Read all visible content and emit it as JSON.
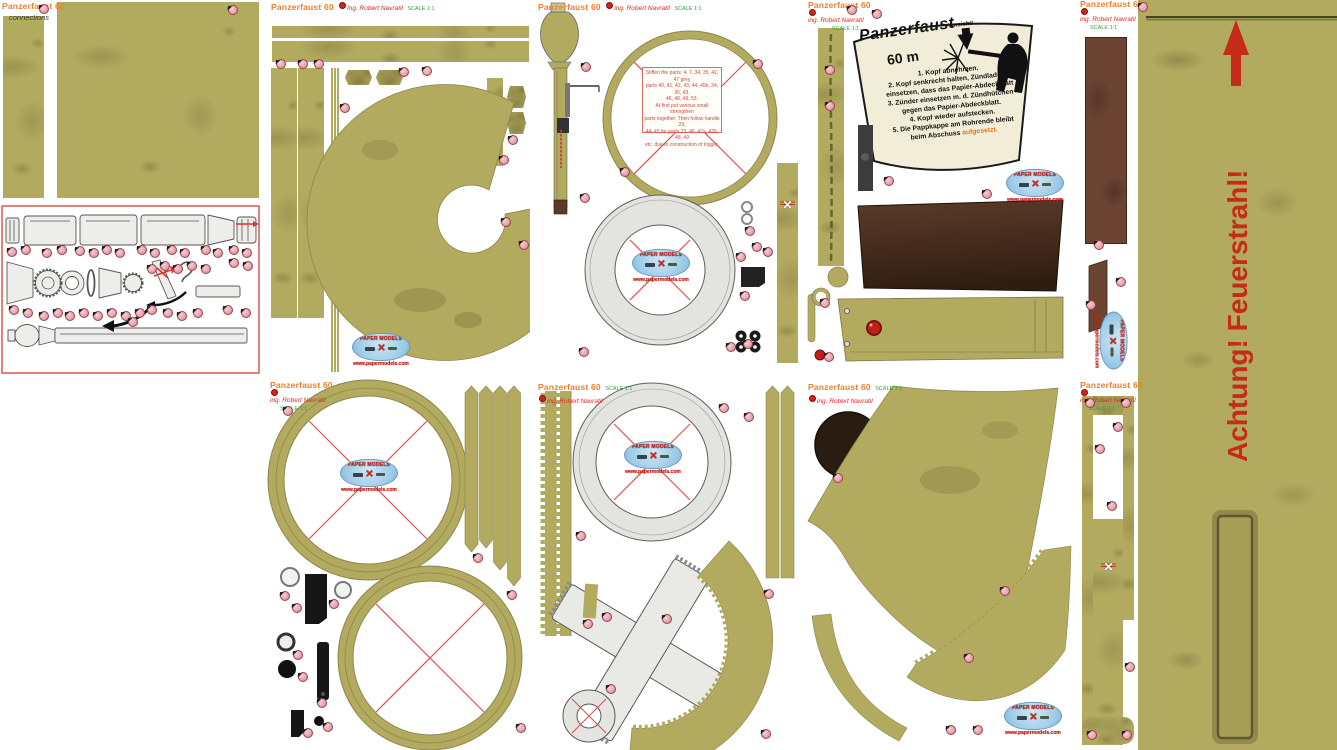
{
  "header": {
    "title": "Panzerfaust 60",
    "author": "ing. Robert Navratil",
    "scale": "SCALE 1:1",
    "subtitle": "connections"
  },
  "logo": {
    "title": "PAPER MODELS",
    "url": "www.papermodels.com"
  },
  "warning_label": {
    "title": "Panzerfaust",
    "range": "60 m",
    "caution": "Vorsicht!",
    "instructions": [
      "1. Kopf abnehmen.",
      "2. Kopf senkrecht halten, Zündladung",
      "einsetzen, dass das Papier-Abdeckblatt",
      "3. Zünder einsetzen m. d. Zündhütchen",
      "gegen das Papier-Abdeckblatt.",
      "4. Kopf wieder aufstecken.",
      "5. Die Pappkappe am Rohrende bleibt",
      "beim Abschuss"
    ],
    "highlight": "aufgesetzt."
  },
  "tube_warning": {
    "text": "Achtung! Feuerstrahl!"
  },
  "note_box": {
    "lines": [
      "Stiffen the parts: 4, 7, 34, 35, 42, 47 grey",
      "parts 40, 41, 42, 43, 44, 45b, 34, 35, 43,",
      "46, 48, 49, 53.",
      "At first put various small strengthen",
      "parts together. Then follow handle 29,",
      "44, 45 for parts 23, 46, 47a, 47b, 48, 49",
      "etc. due to construction of trigger."
    ]
  },
  "colors": {
    "olive": "#b2aa5f",
    "header_orange": "#ef7f2a",
    "author_red": "#e02a20",
    "scale_green": "#2fa43e",
    "warning_red": "#c62a18",
    "dot_pink": "#e8a7b0",
    "paper_gray": "#e3e3df",
    "brown_dark": "#462d1d",
    "brown_red": "#6b4432",
    "logo_blue": "#9ccbe8"
  },
  "glue_dots": [
    [
      44,
      9
    ],
    [
      233,
      10
    ],
    [
      12,
      252
    ],
    [
      26,
      250
    ],
    [
      47,
      253
    ],
    [
      62,
      250
    ],
    [
      80,
      251
    ],
    [
      94,
      253
    ],
    [
      107,
      250
    ],
    [
      120,
      253
    ],
    [
      142,
      250
    ],
    [
      155,
      253
    ],
    [
      172,
      250
    ],
    [
      185,
      253
    ],
    [
      206,
      250
    ],
    [
      218,
      253
    ],
    [
      234,
      250
    ],
    [
      247,
      253
    ],
    [
      14,
      310
    ],
    [
      28,
      313
    ],
    [
      44,
      316
    ],
    [
      58,
      313
    ],
    [
      70,
      316
    ],
    [
      84,
      313
    ],
    [
      98,
      316
    ],
    [
      112,
      313
    ],
    [
      126,
      316
    ],
    [
      140,
      313
    ],
    [
      152,
      310
    ],
    [
      168,
      313
    ],
    [
      182,
      316
    ],
    [
      198,
      313
    ],
    [
      228,
      310
    ],
    [
      246,
      313
    ],
    [
      152,
      269
    ],
    [
      165,
      266
    ],
    [
      178,
      269
    ],
    [
      192,
      266
    ],
    [
      206,
      269
    ],
    [
      234,
      263
    ],
    [
      248,
      266
    ],
    [
      133,
      322
    ],
    [
      281,
      64
    ],
    [
      303,
      64
    ],
    [
      319,
      64
    ],
    [
      404,
      72
    ],
    [
      427,
      71
    ],
    [
      345,
      108
    ],
    [
      513,
      140
    ],
    [
      504,
      160
    ],
    [
      506,
      222
    ],
    [
      524,
      245
    ],
    [
      625,
      172
    ],
    [
      586,
      67
    ],
    [
      758,
      64
    ],
    [
      750,
      231
    ],
    [
      741,
      257
    ],
    [
      768,
      252
    ],
    [
      745,
      296
    ],
    [
      731,
      347
    ],
    [
      585,
      198
    ],
    [
      757,
      247
    ],
    [
      584,
      352
    ],
    [
      748,
      344
    ],
    [
      852,
      10
    ],
    [
      877,
      14
    ],
    [
      830,
      70
    ],
    [
      830,
      106
    ],
    [
      889,
      181
    ],
    [
      987,
      194
    ],
    [
      825,
      303
    ],
    [
      829,
      357
    ],
    [
      1099,
      245
    ],
    [
      1121,
      282
    ],
    [
      1091,
      305
    ],
    [
      1143,
      7
    ],
    [
      1090,
      403
    ],
    [
      1126,
      403
    ],
    [
      1118,
      427
    ],
    [
      1100,
      449
    ],
    [
      1112,
      506
    ],
    [
      1130,
      667
    ],
    [
      1092,
      735
    ],
    [
      1127,
      735
    ],
    [
      288,
      411
    ],
    [
      478,
      558
    ],
    [
      512,
      595
    ],
    [
      285,
      596
    ],
    [
      297,
      608
    ],
    [
      334,
      604
    ],
    [
      298,
      655
    ],
    [
      303,
      677
    ],
    [
      322,
      703
    ],
    [
      308,
      733
    ],
    [
      328,
      727
    ],
    [
      521,
      728
    ],
    [
      581,
      536
    ],
    [
      724,
      408
    ],
    [
      749,
      417
    ],
    [
      588,
      624
    ],
    [
      607,
      617
    ],
    [
      667,
      619
    ],
    [
      611,
      689
    ],
    [
      766,
      734
    ],
    [
      769,
      594
    ],
    [
      838,
      478
    ],
    [
      1005,
      591
    ],
    [
      969,
      658
    ],
    [
      951,
      730
    ],
    [
      978,
      730
    ]
  ]
}
